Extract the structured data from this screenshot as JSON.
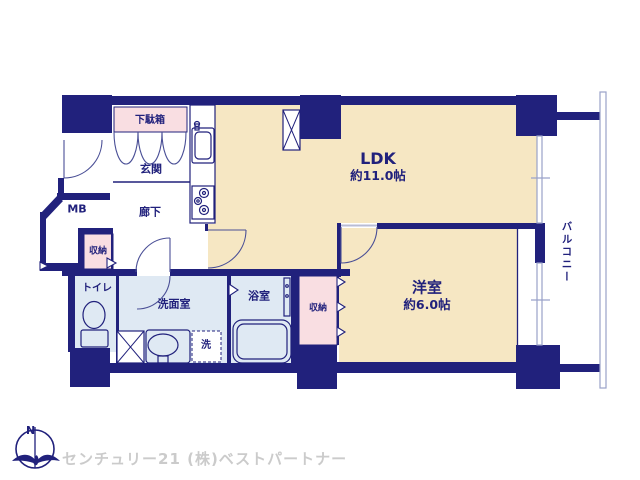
{
  "floor_plan": {
    "rooms": {
      "ldk": {
        "name": "LDK",
        "size": "約11.0帖"
      },
      "yoshitsu": {
        "name": "洋室",
        "size": "約6.0帖"
      },
      "genkan": "玄関",
      "getabako": "下駄箱",
      "rouka": "廊下",
      "mb": "MB",
      "shunou1": "収納",
      "toilet": "トイレ",
      "senmenshitsu": "洗面室",
      "laundry": "洗",
      "yokushitsu": "浴室",
      "shunou2": "収納",
      "balcony": "バルコニー"
    },
    "compass": {
      "north_label": "N"
    },
    "colors": {
      "wall_navy": "#21217c",
      "room_cream": "#f6e7c3",
      "wet_area_blue": "#dfe9f3",
      "closet_pink": "#f9dee2",
      "window_line": "#9aa2c9",
      "logo_text_gray": "#cbcbcb"
    }
  },
  "footer": {
    "company": "センチュリー21 (株)ベストパートナー"
  }
}
